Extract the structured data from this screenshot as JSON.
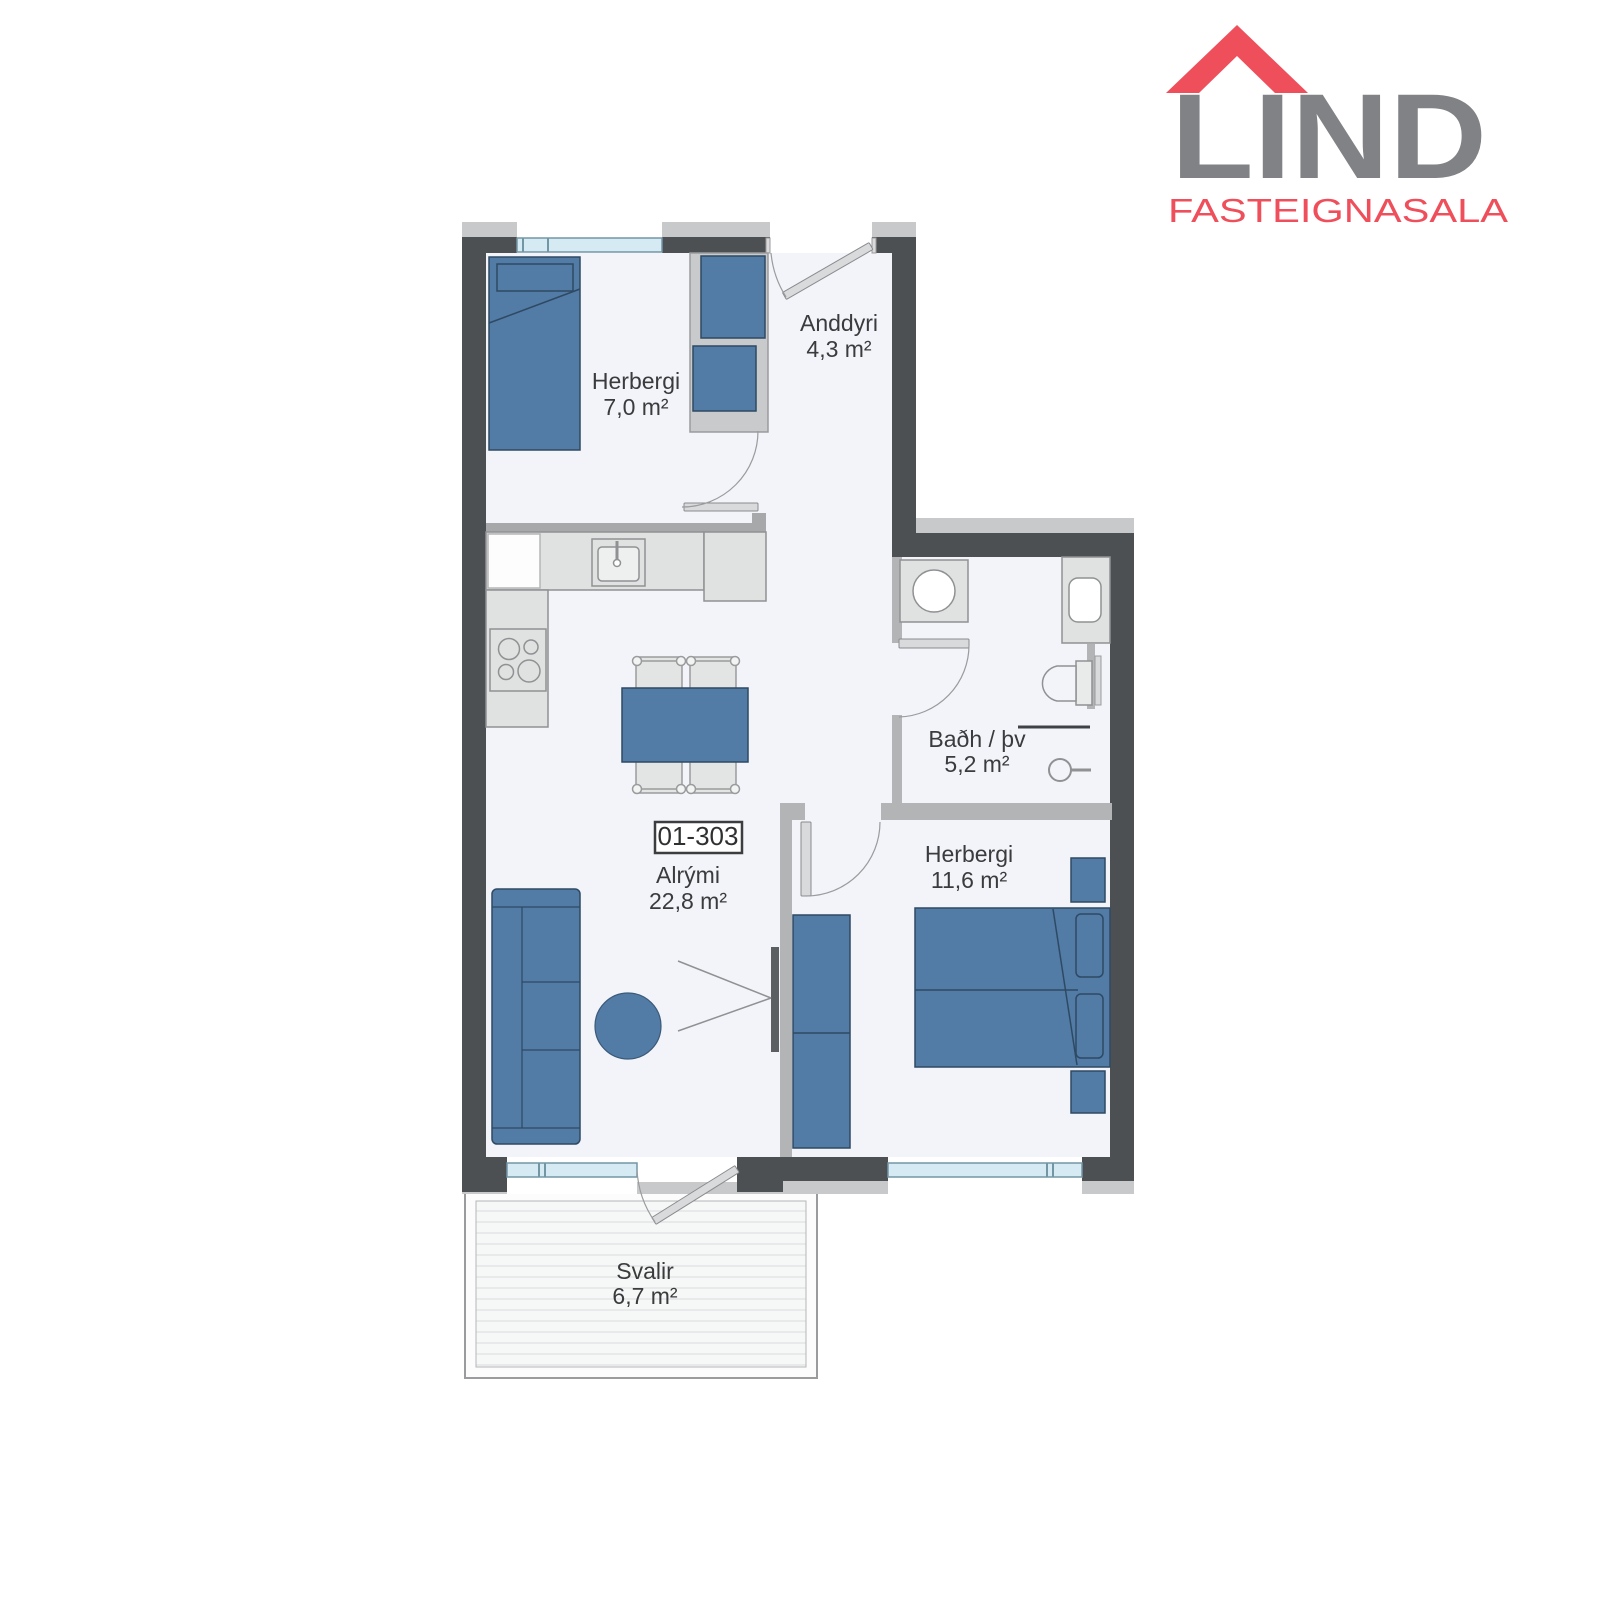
{
  "logo": {
    "brand": "LIND",
    "subtitle": "FASTEIGNASALA"
  },
  "unit": {
    "number": "01-303"
  },
  "rooms": [
    {
      "key": "herbergi1",
      "name": "Herbergi",
      "area": "7,0 m²"
    },
    {
      "key": "anddyri",
      "name": "Anddyri",
      "area": "4,3 m²"
    },
    {
      "key": "bad",
      "name": "Baðh / þv",
      "area": "5,2 m²"
    },
    {
      "key": "herbergi2",
      "name": "Herbergi",
      "area": "11,6 m²"
    },
    {
      "key": "alrymi",
      "name": "Alrými",
      "area": "22,8 m²"
    },
    {
      "key": "svalir",
      "name": "Svalir",
      "area": "6,7 m²"
    }
  ],
  "colors": {
    "wall_dark": "#4d5052",
    "wall_interior": "#b3b4b5",
    "outer_band": "#c8c9ca",
    "floor": "#f2f4f9",
    "furniture_blue": "#527ba6",
    "furniture_outline": "#2e4a63",
    "fixture_fill": "#e0e1e1",
    "fixture_outline": "#8f9193",
    "window_glass": "#d6eaf3",
    "window_frame": "#7396a5",
    "deck": "#f6f7f7",
    "label_text": "#3a3b3c",
    "logo_gray": "#808285",
    "logo_red": "#ef4e5b"
  }
}
